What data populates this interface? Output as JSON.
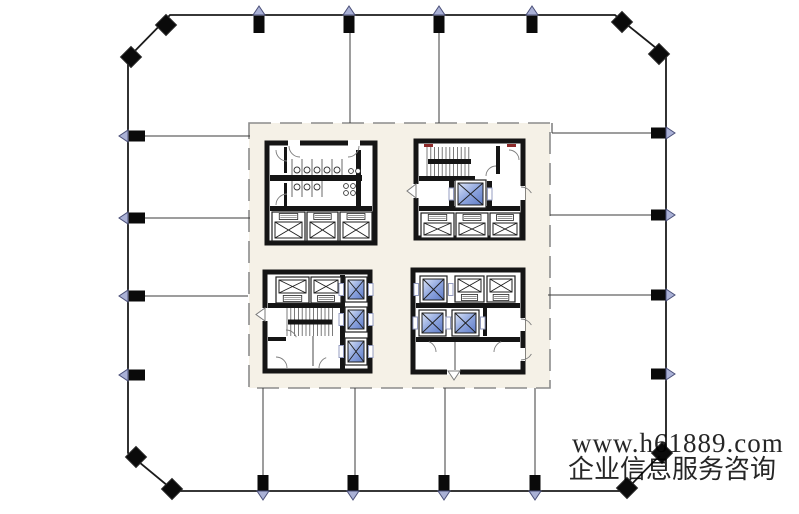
{
  "canvas": {
    "w": 799,
    "h": 514,
    "bg": "#ffffff"
  },
  "colors": {
    "wall": "#151515",
    "perimeter": "#1b1b1b",
    "grid": "#3b3b3b",
    "core_fill": "#f5f1e7",
    "core_border": "#8c8c8c",
    "column_square": "#0a0a0a",
    "triangle_fill": "#aab1d6",
    "triangle_stroke": "#4a4f78",
    "blue_light": "#dce5f8",
    "blue_mid": "#8fa6de",
    "blue_dark": "#5f7cc8",
    "door_arc": "#7d7d7d",
    "stair_tread": "#5a5a5a",
    "stair_marker": "#8e2a2a",
    "watermark": "#e26b6b",
    "smudge": "#d7e5f2"
  },
  "watermark": {
    "line1": "www.h61889.com",
    "line2": "企业信息服务咨询",
    "x1": 572,
    "y1": 452,
    "size1": 27,
    "x2": 568,
    "y2": 478,
    "size2": 26,
    "opacity": 0.85
  },
  "plan": {
    "perimeter": "170,15 615,15 666,56 666,449 625,491 174,491 128,453 128,58",
    "core": [
      249,
      123,
      301,
      265
    ],
    "smudge": [
      480,
      327,
      16,
      22
    ],
    "grid_lines": [
      [
        350,
        16,
        350,
        123
      ],
      [
        439,
        16,
        439,
        123
      ],
      [
        263,
        388,
        263,
        475
      ],
      [
        355,
        388,
        355,
        475
      ],
      [
        445,
        388,
        445,
        475
      ],
      [
        535,
        388,
        535,
        475
      ],
      [
        129,
        136,
        250,
        136
      ],
      [
        129,
        218,
        250,
        218
      ],
      [
        129,
        296,
        248,
        296
      ],
      [
        552,
        133,
        651,
        133
      ],
      [
        550,
        215,
        651,
        215
      ],
      [
        548,
        295,
        651,
        295
      ],
      [
        552,
        123,
        552,
        133
      ]
    ],
    "columns": {
      "top": [
        259,
        349,
        439,
        532
      ],
      "bottom": [
        263,
        353,
        444,
        535
      ],
      "left": [
        136,
        218,
        296,
        375
      ],
      "right": [
        133,
        215,
        295,
        374
      ],
      "corner": [
        [
          166,
          25
        ],
        [
          131,
          57
        ],
        [
          622,
          22
        ],
        [
          659,
          54
        ],
        [
          136,
          457
        ],
        [
          172,
          489
        ],
        [
          662,
          453
        ],
        [
          627,
          488
        ]
      ]
    },
    "blocks": [
      {
        "name": "restroom-block",
        "outline": [
          267,
          143,
          108,
          100
        ],
        "walls": [
          [
            270,
            175,
            92,
            6
          ],
          [
            356,
            150,
            5,
            57
          ],
          [
            284,
            147,
            3,
            26
          ],
          [
            284,
            183,
            3,
            24
          ],
          [
            270,
            206,
            102,
            5
          ]
        ],
        "gaps": [
          [
            288,
            140,
            12,
            6
          ],
          [
            348,
            140,
            12,
            6
          ]
        ],
        "stalls": [
          {
            "x": 292,
            "y1": 159,
            "y2": 175,
            "n": 6,
            "step": 10
          },
          {
            "x": 292,
            "y1": 181,
            "y2": 197,
            "n": 4,
            "step": 10
          }
        ],
        "wcrows": [
          {
            "cx": 297,
            "cy": 170,
            "n": 5,
            "step": 10,
            "r": 3
          },
          {
            "cx": 297,
            "cy": 187,
            "n": 3,
            "step": 10,
            "r": 3
          }
        ],
        "circles": [
          [
            351,
            171,
            2.4
          ],
          [
            358,
            171,
            2.4
          ],
          [
            346,
            186,
            2.4
          ],
          [
            353,
            186,
            2.4
          ],
          [
            346,
            193,
            2.4
          ],
          [
            353,
            193,
            2.4
          ]
        ],
        "arcs": [
          [
            287,
            150,
            11,
            90,
            180
          ],
          [
            287,
            205,
            11,
            180,
            270
          ],
          [
            300,
            146,
            11,
            90,
            180
          ],
          [
            348,
            146,
            11,
            0,
            90
          ]
        ],
        "lifts": [
          {
            "x": 272,
            "y": 212,
            "w": 33,
            "h": 29,
            "door": "top"
          },
          {
            "x": 307,
            "y": 212,
            "w": 31,
            "h": 29,
            "door": "top"
          },
          {
            "x": 340,
            "y": 212,
            "w": 32,
            "h": 29,
            "door": "top"
          }
        ]
      },
      {
        "name": "stair-elevator-block-ne",
        "outline": [
          416,
          141,
          107,
          97
        ],
        "walls": [
          [
            419,
            176,
            56,
            5
          ],
          [
            449,
            181,
            5,
            27
          ],
          [
            487,
            181,
            5,
            27
          ],
          [
            496,
            146,
            4,
            28
          ],
          [
            419,
            206,
            101,
            5
          ]
        ],
        "gaps": [
          [
            412,
            184,
            9,
            14
          ],
          [
            517,
            186,
            8,
            14
          ]
        ],
        "stairs": [
          [
            427,
            147,
            45,
            29
          ]
        ],
        "marks": [
          [
            424,
            144,
            9,
            3
          ],
          [
            507,
            144,
            9,
            3
          ]
        ],
        "arcs": [
          [
            496,
            176,
            10,
            180,
            270
          ],
          [
            509,
            160,
            10,
            270,
            360
          ],
          [
            521,
            199,
            12,
            270,
            330
          ]
        ],
        "tris": [
          "416,184 416,198 407,191"
        ],
        "lifts": [
          {
            "x": 455,
            "y": 180,
            "w": 31,
            "h": 28,
            "blue": true,
            "pk": "lr"
          },
          {
            "x": 421,
            "y": 213,
            "w": 33,
            "h": 25,
            "door": "top"
          },
          {
            "x": 456,
            "y": 213,
            "w": 32,
            "h": 25,
            "door": "top"
          },
          {
            "x": 490,
            "y": 213,
            "w": 30,
            "h": 25,
            "door": "top"
          }
        ]
      },
      {
        "name": "stair-elevator-block-sw",
        "outline": [
          265,
          272,
          105,
          99
        ],
        "walls": [
          [
            268,
            303,
            74,
            5
          ],
          [
            340,
            275,
            5,
            94
          ],
          [
            268,
            337,
            18,
            4
          ]
        ],
        "gaps": [
          [
            261,
            308,
            8,
            13
          ]
        ],
        "stairs": [
          [
            287,
            308,
            46,
            28
          ]
        ],
        "lines": [
          [
            313,
            336,
            313,
            366
          ]
        ],
        "arcs": [
          [
            286,
            341,
            11,
            270,
            340
          ],
          [
            276,
            368,
            11,
            270,
            360
          ],
          [
            330,
            368,
            11,
            180,
            250
          ]
        ],
        "tris": [
          "265,308 265,321 256,314.5"
        ],
        "lifts": [
          {
            "x": 276,
            "y": 277,
            "w": 33,
            "h": 26,
            "door": "bottom"
          },
          {
            "x": 311,
            "y": 277,
            "w": 30,
            "h": 26,
            "door": "bottom"
          },
          {
            "x": 345,
            "y": 277,
            "w": 22,
            "h": 25,
            "blue": true,
            "pk": "lr"
          },
          {
            "x": 345,
            "y": 307,
            "w": 22,
            "h": 25,
            "blue": true,
            "pk": "lr"
          },
          {
            "x": 345,
            "y": 338,
            "w": 22,
            "h": 27,
            "blue": true,
            "pk": "lr"
          }
        ]
      },
      {
        "name": "elevator-block-se",
        "outline": [
          413,
          270,
          110,
          102
        ],
        "walls": [
          [
            416,
            303,
            104,
            5
          ],
          [
            483,
            308,
            4,
            28
          ],
          [
            416,
            337,
            104,
            5
          ]
        ],
        "gaps": [
          [
            517,
            318,
            8,
            13
          ],
          [
            517,
            348,
            8,
            13
          ],
          [
            447,
            368,
            13,
            7
          ]
        ],
        "lines": [
          [
            455,
            342,
            455,
            370
          ]
        ],
        "arcs": [
          [
            521,
            331,
            12,
            270,
            330
          ],
          [
            521,
            348,
            12,
            30,
            90
          ],
          [
            425,
            352,
            11,
            290,
            360
          ],
          [
            505,
            352,
            11,
            180,
            250
          ]
        ],
        "tris": [
          "448,371 460,371 454,380"
        ],
        "lifts": [
          {
            "x": 420,
            "y": 276,
            "w": 27,
            "h": 27,
            "blue": true,
            "pk": "lr"
          },
          {
            "x": 455,
            "y": 276,
            "w": 29,
            "h": 26,
            "door": "bottom"
          },
          {
            "x": 487,
            "y": 276,
            "w": 28,
            "h": 26,
            "door": "bottom"
          },
          {
            "x": 419,
            "y": 310,
            "w": 27,
            "h": 26,
            "blue": true,
            "pk": "lr"
          },
          {
            "x": 452,
            "y": 310,
            "w": 27,
            "h": 26,
            "blue": true,
            "pk": "lr"
          }
        ]
      }
    ]
  }
}
